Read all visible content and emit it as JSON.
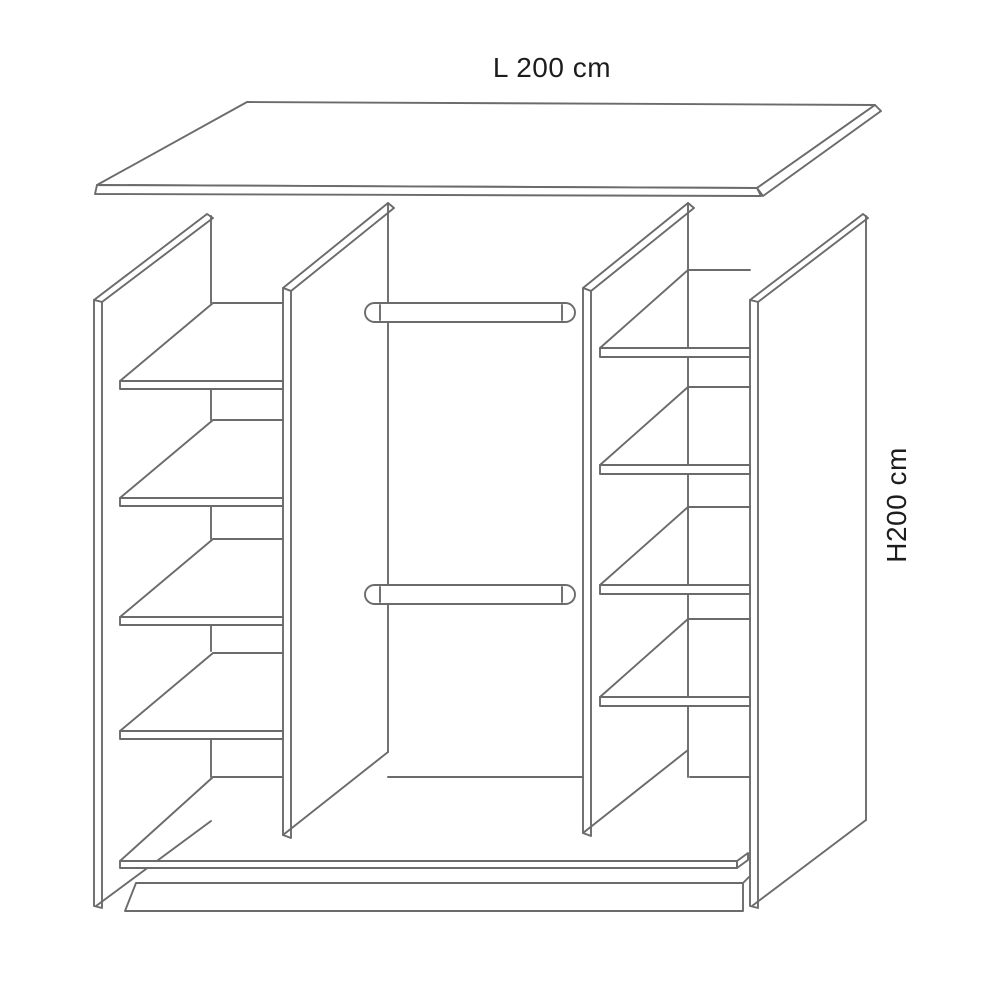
{
  "diagram": {
    "title": "wardrobe interior technical drawing",
    "width_label": "L 200 cm",
    "height_label": "H200 cm",
    "structure": {
      "left_shelf_count": 4,
      "right_shelf_count": 4,
      "hanging_rail_count": 2,
      "width_cm": 200,
      "height_cm": 200
    }
  },
  "colors": {
    "line": "#6b6b6b",
    "text": "#1d1d1d",
    "background": "#ffffff"
  }
}
